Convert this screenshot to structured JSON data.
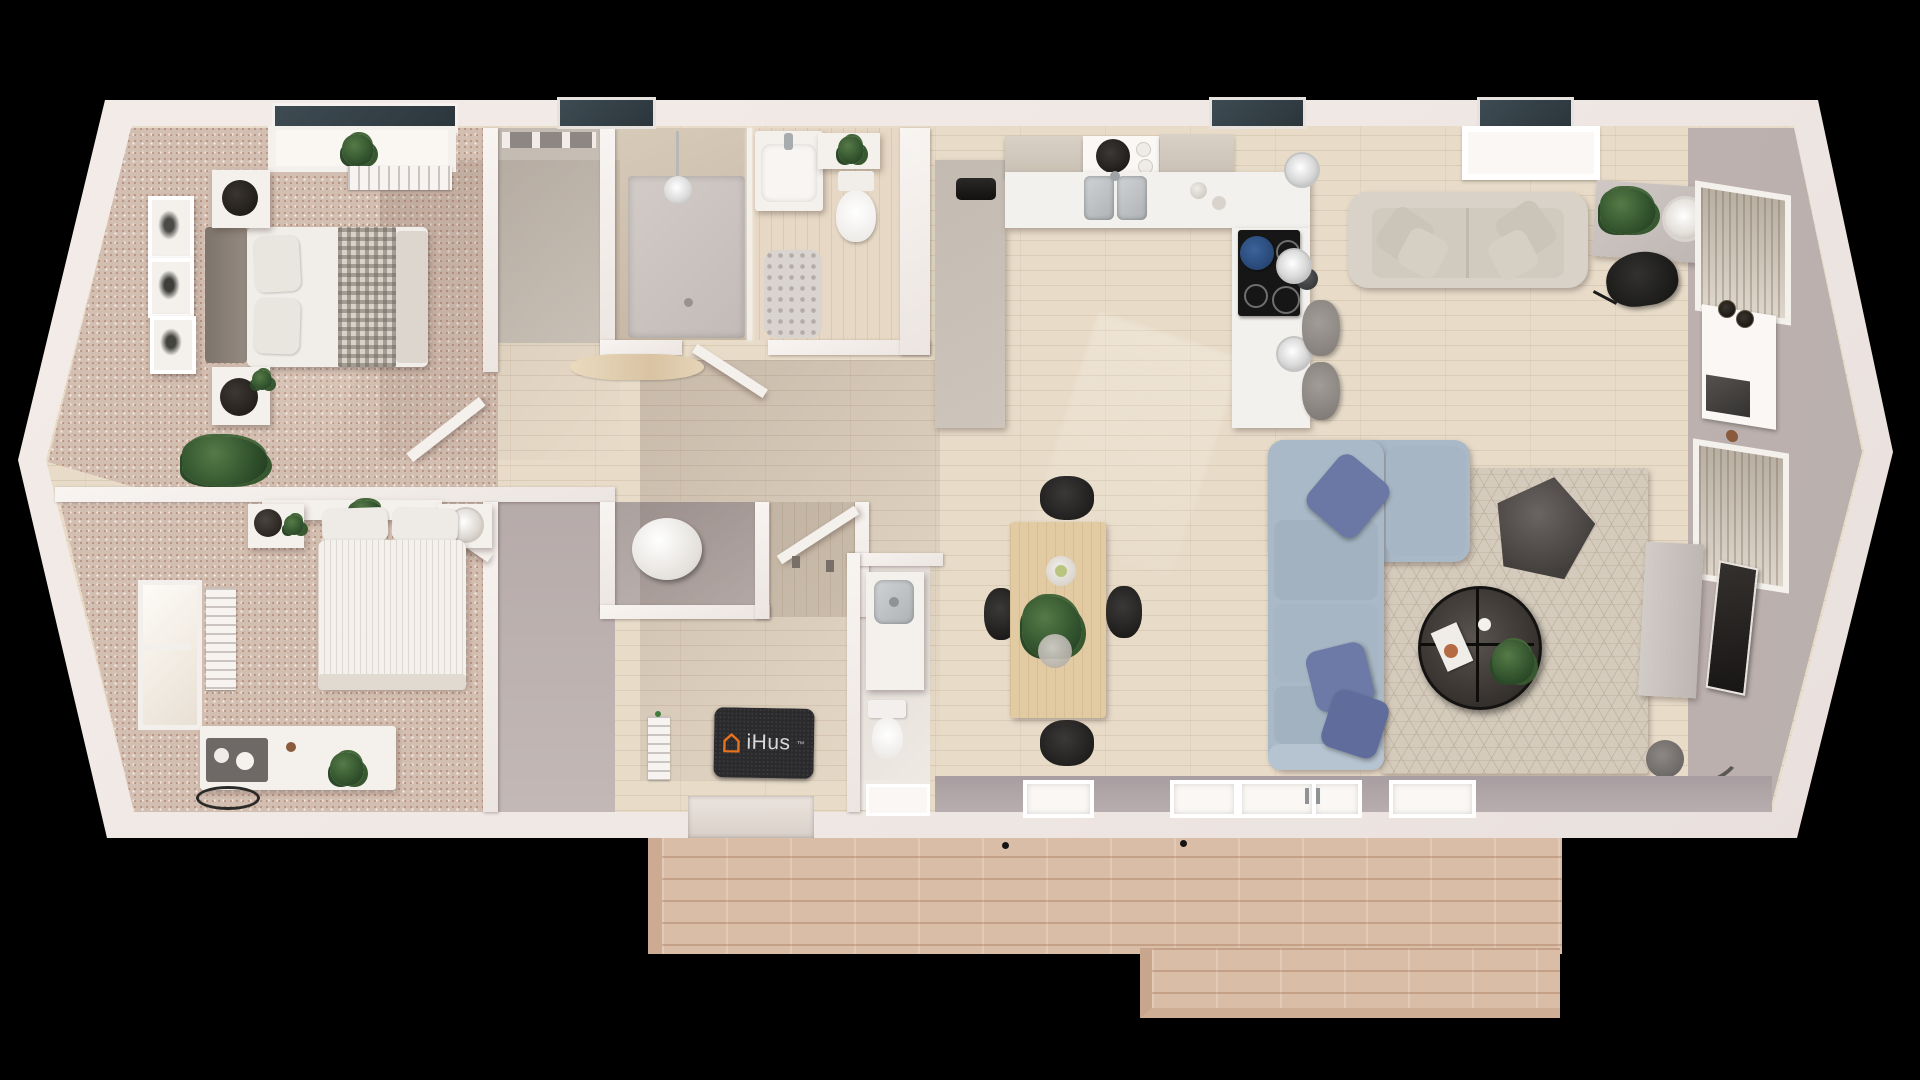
{
  "scene": {
    "description": "Top-down 3D architectural render of a two-bedroom iHus annexe floor plan with open-plan kitchen, dining and living area, bathroom, WC, hallway and front decking",
    "brand": {
      "logo_text": "iHus",
      "trademark": "™"
    },
    "icons": {
      "ihus_house_icon": "orange outlined house glyph on entrance doormat"
    },
    "rooms": [
      {
        "name": "bedroom-1"
      },
      {
        "name": "bedroom-2"
      },
      {
        "name": "bathroom"
      },
      {
        "name": "wc"
      },
      {
        "name": "hallway"
      },
      {
        "name": "kitchen"
      },
      {
        "name": "dining-area"
      },
      {
        "name": "living-area"
      },
      {
        "name": "entrance-hall"
      },
      {
        "name": "deck"
      }
    ]
  },
  "colors": {
    "accent_orange": "#e8731c",
    "mat_dark": "#2a2a2c",
    "wall_outer": "#f1eae6",
    "wall_face": "#b3a8a7",
    "carpet": "#d3bfb1",
    "wood": "#e8dcc9",
    "deck": "#dabda7",
    "marble": "#f3f1ed",
    "sofa_blue": "#aab9c7",
    "cushion_navy": "#6b77a4",
    "sofa_cream": "#d8d2c8",
    "rug": "#d4cbbc",
    "pouf": "#56514f",
    "chair_black": "#232221",
    "table_wood": "#e2cba3",
    "plant_green": "#3c5c34",
    "steel": "#b9bdbf",
    "hob_black": "#161616",
    "window_glass": "#46535a"
  }
}
